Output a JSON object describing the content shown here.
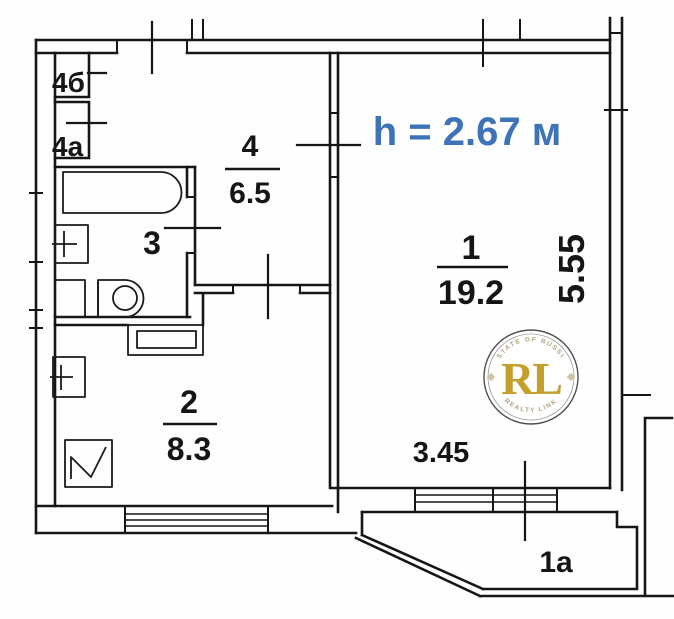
{
  "plan": {
    "height_note": "h = 2.67 м",
    "room1": {
      "number": "1",
      "area": "19.2"
    },
    "room1a": {
      "label": "1a"
    },
    "room2": {
      "number": "2",
      "area": "8.3"
    },
    "room3": {
      "number": "3"
    },
    "room4": {
      "number": "4",
      "area": "6.5"
    },
    "closet4b": {
      "label": "4б"
    },
    "closet4a": {
      "label": "4a"
    },
    "dimensions": {
      "room1_width": "3.45",
      "room1_height": "5.55"
    },
    "colors": {
      "note_blue": "#3e73b8",
      "wall_black": "#161616",
      "watermark_gold": "#c49f2e",
      "watermark_ring_gray": "#4f4f4f",
      "watermark_arc_tan": "#b5a47c"
    }
  },
  "watermark": {
    "monogram": "RL",
    "arc_top": "ESTATE OF RUSSIA",
    "arc_bottom": "REALTY LINK"
  }
}
